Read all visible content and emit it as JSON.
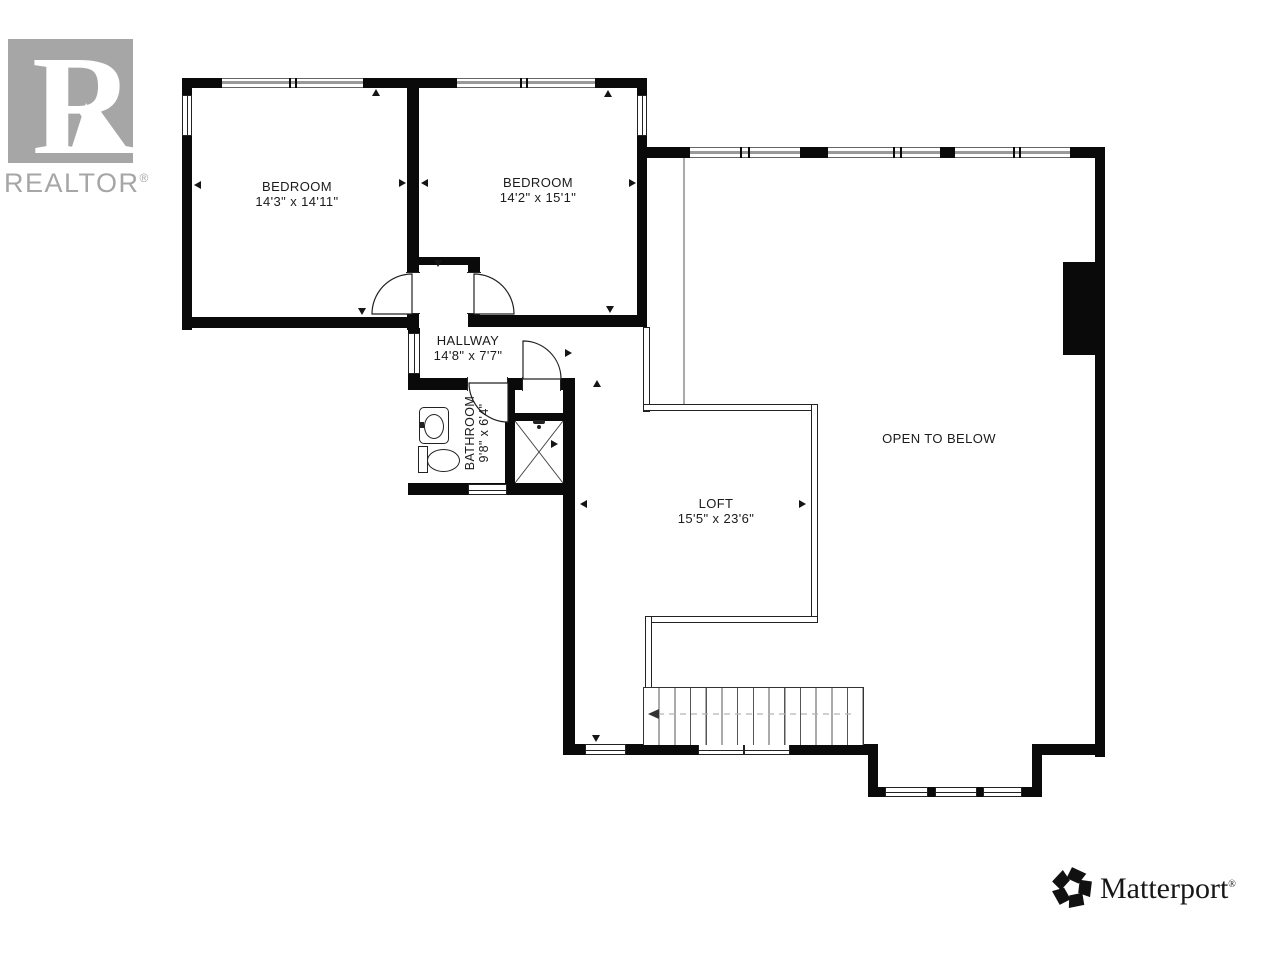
{
  "branding": {
    "realtor": {
      "r": "R",
      "word": "REALTOR",
      "reg": "®"
    },
    "matterport": {
      "word": "Matterport",
      "reg": "®"
    }
  },
  "rooms": [
    {
      "name": "BEDROOM",
      "dims": "14'3\" x 14'11\""
    },
    {
      "name": "BEDROOM",
      "dims": "14'2\" x 15'1\""
    },
    {
      "name": "HALLWAY",
      "dims": "14'8\" x 7'7\""
    },
    {
      "name": "BATHROOM",
      "dims": "9'8\" x 6'4\""
    },
    {
      "name": "LOFT",
      "dims": "15'5\" x 23'6\""
    },
    {
      "name": "OPEN TO BELOW",
      "dims": ""
    }
  ],
  "colors": {
    "wall": "#0a0a0a",
    "accent_gray": "#a6a6a6",
    "label": "#1b1b1b"
  }
}
